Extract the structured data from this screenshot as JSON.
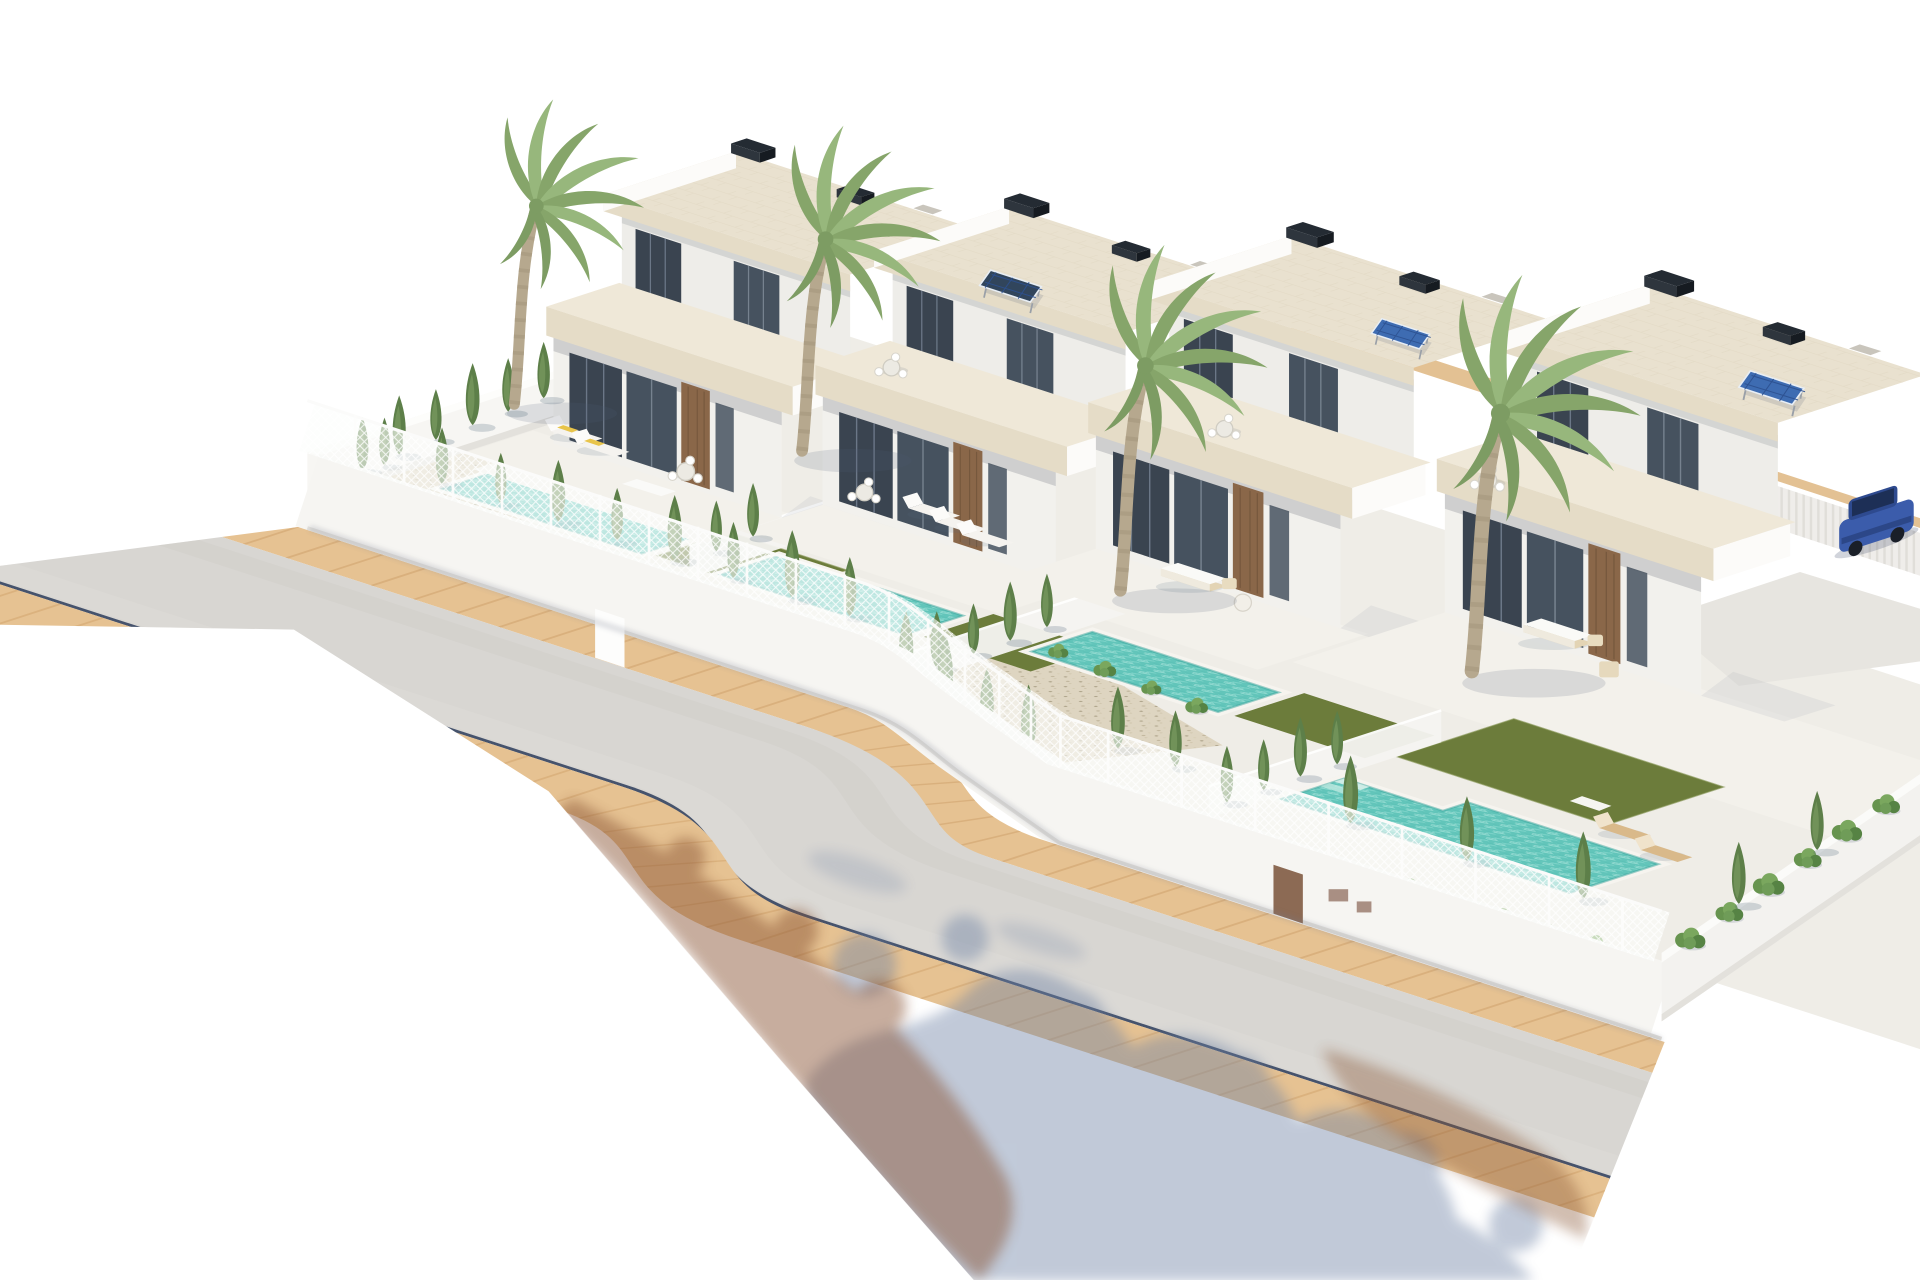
{
  "scene": {
    "description": "Aerial isometric 3D architectural rendering of four modern two-storey white villas with flat travertine roof terraces, private turquoise pools, artificial lawns, cypress hedges and palm trees; a curved grey road with sand-coloured paver sidewalks passes in front; tree shadows fall across the road at the bottom; plain white background",
    "villa_count": 4,
    "pool_count": 4,
    "palm_tree_count": 4,
    "vehicle_count": 1,
    "solar_panel_count": 3,
    "lighting": "bright daylight, shadows cast to lower-right"
  },
  "objects": {
    "villa_1": "white villa, roof deck with two chimneys, loungers with yellow towels",
    "villa_2": "white villa with rooftop solar-thermal panel, three pool loungers",
    "villa_3": "white villa with rooftop solar panel, white garden sofa set, gravel garden",
    "villa_4": "corner white villa with solar panel, large lawn, L-shaped pool, two wood loungers, parked blue car",
    "road": "curved light grey asphalt road",
    "sidewalks": "sand coloured paver sidewalks on both road sides",
    "curb_line": "dark blue-grey gutter line along far road edge",
    "front_fence": "white wall topped with white mesh fencing, service door and meter boxes",
    "boundary_walls": "white perimeter walls left and right",
    "rear_boundary": "tan path with white slat fence behind the plots",
    "vegetation": "columnar cypresses, mediterranean hedges, shrub beds, four tall palms",
    "shadows": "blue-grey tree shadows on road, warm brown shadows on sidewalk"
  },
  "colors": {
    "bg": "#ffffff",
    "ground": "#efede7",
    "terrace": "#f3f1eb",
    "road": "#d8d6d2",
    "road_dark": "#cdcac5",
    "road_light": "#e0deda",
    "sidewalk": "#e6c292",
    "sidewalk_joint": "#d3a671",
    "curb": "#46536c",
    "wall_bright": "#fcfbf9",
    "wall_front": "#f2f1ed",
    "wall_shaded": "#eeede9",
    "fence_wall": "#f6f5f2",
    "mesh_white": "#fdfdfc",
    "travertine": "#e5dcc7",
    "travertine_light": "#efe8d8",
    "deck": "#e9e1cf",
    "glass": "#3a4450",
    "glass_light": "#46525f",
    "wood": "#8a6749",
    "coping": "#f6f4ef",
    "pool_water": "#62c5ba",
    "pool_ripple": "#b9ece4",
    "pool_deep": "#3ea69d",
    "lawn": "#6c7c3b",
    "lawn_edge": "#7d8d4a",
    "gravel": "#ded5c1",
    "cypress": "#5d7f49",
    "cypress_light": "#74955c",
    "hedge": "#67944f",
    "hedge_light": "#7aa75e",
    "palm_frond": "#86a56a",
    "palm_frond_light": "#97b77c",
    "palm_trunk": "#b6a88e",
    "chimney": "#242b33",
    "solar": "#3e6cb2",
    "solar_grid": "#2d5190",
    "car_blue": "#3b5cab",
    "car_cabin": "#2e4a8f",
    "car_glass": "#1c2c50",
    "slat": "#efedea",
    "lounger_wood": "#d9b98a",
    "towel_yellow": "#e8c44a",
    "sofa_wicker": "#e3d4b4",
    "shadow_blue": "#6d81a4",
    "shadow_brown": "#8a5534",
    "door_brown": "#8c6a54",
    "rear_path": "#e3c193"
  }
}
